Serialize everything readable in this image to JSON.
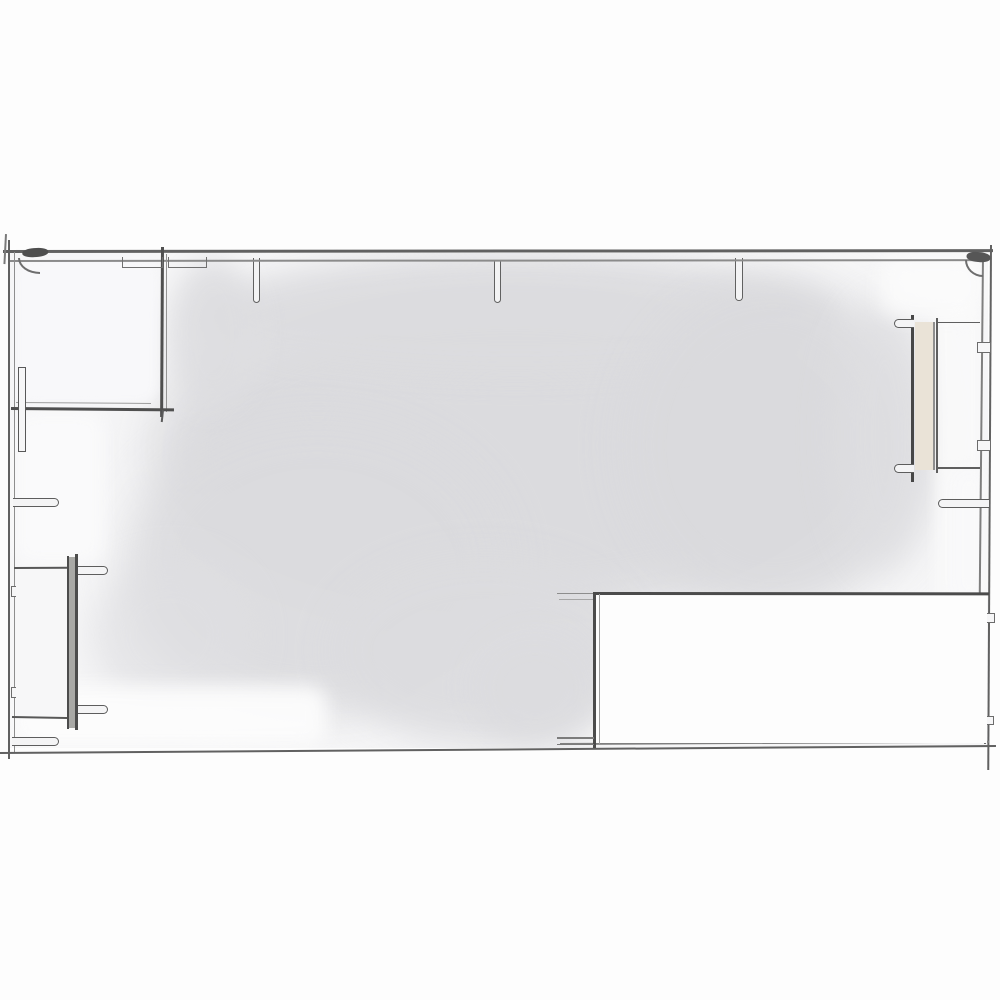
{
  "meta": {
    "description": "hand-drawn architectural floor plan sketch, pencil lines with light gray watercolor wash",
    "canvas_width": 1000,
    "canvas_height": 1000
  },
  "colors": {
    "paper": "#fdfdfd",
    "wash": "#dadadd",
    "line_dark": "#4b4b4b",
    "line_mid": "#616161",
    "line_light": "#8e8e8e",
    "panel_beige": "#eae3d7",
    "bar_gray": "#a9a9a6"
  },
  "plan": {
    "clip": {
      "x": 10,
      "y": 253,
      "w": 978,
      "h": 495
    },
    "wash": [
      {
        "name": "wash-blob-main",
        "type": "blob",
        "x": 150,
        "y": 278,
        "w": 720,
        "h": 345,
        "c": "#dadadd",
        "blur": 26,
        "op": 0.95
      },
      {
        "name": "wash-blob-top-band",
        "type": "blob",
        "x": 195,
        "y": 256,
        "w": 640,
        "h": 120,
        "c": "#dcdcdf",
        "blur": 15,
        "op": 0.9
      },
      {
        "name": "wash-blob-right",
        "type": "blob",
        "x": 620,
        "y": 278,
        "w": 305,
        "h": 335,
        "c": "#dadadd",
        "blur": 22,
        "op": 0.9
      },
      {
        "name": "wash-blob-left-lower",
        "type": "blob",
        "x": 125,
        "y": 415,
        "w": 385,
        "h": 300,
        "c": "#dbdbde",
        "blur": 22,
        "op": 0.9
      },
      {
        "name": "wash-blob-bottom",
        "type": "blob",
        "x": 330,
        "y": 555,
        "w": 310,
        "h": 190,
        "c": "#dcdcdf",
        "blur": 18,
        "op": 0.92
      },
      {
        "name": "wash-blob-right-edge",
        "type": "blob",
        "x": 835,
        "y": 300,
        "w": 100,
        "h": 270,
        "c": "#dedee1",
        "blur": 18,
        "op": 0.75
      },
      {
        "name": "wash-blob-room-edge",
        "type": "blob",
        "x": 168,
        "y": 258,
        "w": 90,
        "h": 150,
        "c": "#dddde0",
        "blur": 13,
        "op": 0.85
      },
      {
        "name": "wash-blob-bottom-left",
        "type": "blob",
        "x": 90,
        "y": 560,
        "w": 160,
        "h": 150,
        "c": "#dfdfe2",
        "blur": 18,
        "op": 0.7
      },
      {
        "name": "wash-blob-bottom-strip",
        "type": "blob",
        "x": 470,
        "y": 630,
        "w": 130,
        "h": 115,
        "c": "#dcdcdf",
        "blur": 15,
        "op": 0.9
      },
      {
        "name": "white-room1-interior",
        "type": "cover",
        "x": 17,
        "y": 258,
        "w": 141,
        "h": 146,
        "c": "rgba(248,248,250,0.95)",
        "blur": 5
      },
      {
        "name": "white-left-strip",
        "type": "cover",
        "x": 14,
        "y": 412,
        "w": 90,
        "h": 152,
        "c": "rgba(250,250,251,0.95)",
        "blur": 8
      },
      {
        "name": "white-bottom-left",
        "type": "cover",
        "x": 12,
        "y": 686,
        "w": 315,
        "h": 60,
        "c": "rgba(252,252,252,0.95)",
        "blur": 9
      },
      {
        "name": "white-right-strip",
        "type": "cover",
        "x": 936,
        "y": 305,
        "w": 46,
        "h": 305,
        "c": "rgba(249,249,250,0.9)",
        "blur": 6
      },
      {
        "name": "white-top-right",
        "type": "cover",
        "x": 880,
        "y": 255,
        "w": 105,
        "h": 62,
        "c": "rgba(251,251,252,0.85)",
        "blur": 10
      },
      {
        "name": "white-right-margin-low",
        "type": "cover",
        "x": 952,
        "y": 468,
        "w": 34,
        "h": 135,
        "c": "rgba(249,249,250,0.8)",
        "blur": 8
      }
    ],
    "elements": [
      {
        "name": "column-stub-top-1",
        "type": "stub",
        "x": 252.5,
        "y": 258,
        "w": 7.5,
        "h": 45,
        "t": 1.8,
        "c": "#616161",
        "open": "top",
        "fill": "#f3f3f4"
      },
      {
        "name": "column-stub-top-2",
        "type": "stub",
        "x": 493.5,
        "y": 260,
        "w": 7.5,
        "h": 43,
        "t": 1.8,
        "c": "#616161",
        "open": "top",
        "fill": "#f3f3f4"
      },
      {
        "name": "column-stub-top-3",
        "type": "stub",
        "x": 735,
        "y": 258,
        "w": 7.5,
        "h": 43,
        "t": 1.8,
        "c": "#616161",
        "open": "top",
        "fill": "#f3f3f4"
      },
      {
        "name": "wall-top-outer",
        "type": "hline",
        "x": 3,
        "y": 250,
        "w": 990,
        "h": 2.6,
        "c": "#616161",
        "rot": -0.05
      },
      {
        "name": "wall-top-inner",
        "type": "hline",
        "x": 8,
        "y": 259.5,
        "w": 975,
        "h": 1.8,
        "c": "#8b8b8b",
        "rot": -0.05
      },
      {
        "name": "wall-left-outer",
        "type": "vline",
        "x": 7.5,
        "y": 240,
        "w": 2.3,
        "h": 519,
        "c": "#616161"
      },
      {
        "name": "wall-left-inner",
        "type": "vline",
        "x": 13.5,
        "y": 252,
        "w": 1.7,
        "h": 500,
        "c": "#8e8e8e"
      },
      {
        "name": "wall-left-overshoot",
        "type": "vline",
        "x": 4.5,
        "y": 234,
        "w": 1.6,
        "h": 30,
        "c": "#7a7a7a",
        "rot": 3
      },
      {
        "name": "wall-right-outer",
        "type": "vline",
        "x": 989.5,
        "y": 245,
        "w": 2.4,
        "h": 525,
        "c": "#616161",
        "rot": 0.3
      },
      {
        "name": "wall-right-inner",
        "type": "vline",
        "x": 982,
        "y": 256,
        "w": 1.8,
        "h": 352,
        "c": "#7f7f7f",
        "rot": 0.55
      },
      {
        "name": "wall-bottom-outer",
        "type": "hline",
        "x": 0,
        "y": 752,
        "w": 996,
        "h": 2.3,
        "c": "#616161",
        "rot": -0.4
      },
      {
        "name": "wall-bottom-inner",
        "type": "hline",
        "x": 560,
        "y": 743,
        "w": 429,
        "h": 1.7,
        "c": "#7f7f7f",
        "rot": -0.3
      },
      {
        "name": "corner-knot-tl",
        "type": "fill",
        "x": 22,
        "y": 249,
        "w": 26,
        "h": 9,
        "c": "#4e4e4e",
        "rot": -4,
        "rad": "45%"
      },
      {
        "name": "corner-arc-tl",
        "type": "arc",
        "x": 18,
        "y": 258,
        "w": 22,
        "h": 16,
        "t": 2,
        "c": "#6e6e6e",
        "corner": "bl"
      },
      {
        "name": "corner-knot-tr",
        "type": "fill",
        "x": 967,
        "y": 251,
        "w": 24,
        "h": 10,
        "c": "#565656",
        "rot": 5,
        "rad": "45%"
      },
      {
        "name": "corner-arc-tr",
        "type": "arc",
        "x": 965,
        "y": 260,
        "w": 18,
        "h": 17,
        "t": 2,
        "c": "#6e6e6e",
        "corner": "bl"
      },
      {
        "name": "room1-wall-vertical",
        "type": "vline",
        "x": 160.5,
        "y": 247,
        "w": 2.9,
        "h": 170,
        "c": "#4f4f4f",
        "rot": 0.3
      },
      {
        "name": "room1-wall-vertical-double",
        "type": "vline",
        "x": 166,
        "y": 254,
        "w": 1.4,
        "h": 158,
        "c": "#949494"
      },
      {
        "name": "room1-wall-horizontal",
        "type": "hline",
        "x": 11,
        "y": 406.5,
        "w": 163,
        "h": 2.9,
        "c": "#4f4f4f",
        "rot": 0.5
      },
      {
        "name": "room1-wall-horizontal-double",
        "type": "hline",
        "x": 16,
        "y": 402,
        "w": 135,
        "h": 1.3,
        "c": "#9e9e9e",
        "rot": 0.4
      },
      {
        "name": "room1-wall-overshoot",
        "type": "vline",
        "x": 162,
        "y": 410,
        "w": 2.2,
        "h": 12,
        "c": "#5a5a5a",
        "rot": 6
      },
      {
        "name": "opening-bracket-left",
        "type": "bracket",
        "x": 122,
        "y": 256.5,
        "w": 41,
        "h": 11,
        "t": 1.8,
        "c": "#707070"
      },
      {
        "name": "opening-bracket-right",
        "type": "bracket",
        "x": 167.5,
        "y": 256.5,
        "w": 39,
        "h": 11,
        "t": 1.8,
        "c": "#707070"
      },
      {
        "name": "door-leaf-left",
        "type": "rect",
        "x": 17.5,
        "y": 367,
        "w": 8,
        "h": 85,
        "t": 1.9,
        "c": "#585858",
        "fill": "#f6f6f7"
      },
      {
        "name": "door-stub-left-1",
        "type": "stub",
        "x": 13,
        "y": 497.5,
        "w": 46,
        "h": 9.5,
        "t": 1.8,
        "c": "#5d5d5d",
        "open": "left",
        "fill": "#f4f4f5"
      },
      {
        "name": "wall-tab-left-1",
        "type": "rect",
        "x": 10.5,
        "y": 586,
        "w": 10.5,
        "h": 11,
        "t": 1.5,
        "c": "#6c6c6c",
        "fill": "#f6f6f7"
      },
      {
        "name": "wall-tab-left-2",
        "type": "rect",
        "x": 10.5,
        "y": 687,
        "w": 10.5,
        "h": 11,
        "t": 1.5,
        "c": "#6c6c6c",
        "fill": "#f6f6f7"
      },
      {
        "name": "door-stub-left-2",
        "type": "stub",
        "x": 12,
        "y": 736.5,
        "w": 47,
        "h": 9,
        "t": 1.8,
        "c": "#5d5d5d",
        "open": "left",
        "fill": "#f4f4f5"
      },
      {
        "name": "room2-fill",
        "type": "fill",
        "x": 16,
        "y": 569,
        "w": 51,
        "h": 147,
        "c": "#f7f7f8"
      },
      {
        "name": "room2-wall-top",
        "type": "hline",
        "x": 14,
        "y": 567,
        "w": 54,
        "h": 2.1,
        "c": "#575757",
        "rot": -0.3
      },
      {
        "name": "room2-wall-bottom",
        "type": "hline",
        "x": 12,
        "y": 716,
        "w": 62,
        "h": 2.3,
        "c": "#575757",
        "rot": 1
      },
      {
        "name": "room2-bar-fill",
        "type": "fill",
        "x": 69,
        "y": 557,
        "w": 6.5,
        "h": 171,
        "c": "#a9a9a6"
      },
      {
        "name": "room2-bar-left-line",
        "type": "vline",
        "x": 66.8,
        "y": 556,
        "w": 2.3,
        "h": 173,
        "c": "#4c4c4c"
      },
      {
        "name": "room2-bar-right-line",
        "type": "vline",
        "x": 75.3,
        "y": 554,
        "w": 2.3,
        "h": 176,
        "c": "#4c4c4c"
      },
      {
        "name": "door-stub-bl-1",
        "type": "stub",
        "x": 78,
        "y": 566,
        "w": 30,
        "h": 9,
        "t": 1.7,
        "c": "#5d5d5d",
        "open": "left",
        "fill": "#f4f4f5"
      },
      {
        "name": "door-stub-bl-2",
        "type": "stub",
        "x": 78,
        "y": 704.5,
        "w": 30,
        "h": 9,
        "t": 1.7,
        "c": "#5d5d5d",
        "open": "left",
        "fill": "#f4f4f5"
      },
      {
        "name": "door2-jamb-line",
        "type": "vline",
        "x": 910.5,
        "y": 315,
        "w": 3,
        "h": 167,
        "c": "#474747"
      },
      {
        "name": "door2-panel",
        "type": "fill",
        "x": 914.5,
        "y": 322,
        "w": 18.5,
        "h": 148,
        "c": "#eae3d7"
      },
      {
        "name": "door2-panel-edge",
        "type": "vline",
        "x": 933,
        "y": 322,
        "w": 1.7,
        "h": 148,
        "c": "#8f8f8f"
      },
      {
        "name": "door2-inner-line",
        "type": "vline",
        "x": 936.2,
        "y": 318,
        "w": 1.9,
        "h": 155,
        "c": "#5f5f5f"
      },
      {
        "name": "door2-top-line",
        "type": "hline",
        "x": 937,
        "y": 321.5,
        "w": 43,
        "h": 1.9,
        "c": "#5f5f5f"
      },
      {
        "name": "door2-bottom-line",
        "type": "hline",
        "x": 937,
        "y": 467,
        "w": 43,
        "h": 1.9,
        "c": "#5f5f5f"
      },
      {
        "name": "door-stub-right-top",
        "type": "stub",
        "x": 894,
        "y": 319,
        "w": 20,
        "h": 9,
        "t": 1.7,
        "c": "#5d5d5d",
        "open": "right",
        "fill": "#f4f4f5"
      },
      {
        "name": "door-stub-right-bottom",
        "type": "stub",
        "x": 894,
        "y": 464,
        "w": 20,
        "h": 9,
        "t": 1.7,
        "c": "#5d5d5d",
        "open": "right",
        "fill": "#f4f4f5"
      },
      {
        "name": "wall-tab-right-1",
        "type": "rect",
        "x": 976.5,
        "y": 342,
        "w": 14,
        "h": 10.5,
        "t": 1.5,
        "c": "#6c6c6c",
        "fill": "#f6f6f7"
      },
      {
        "name": "wall-tab-right-2",
        "type": "rect",
        "x": 976.5,
        "y": 440,
        "w": 14,
        "h": 10.5,
        "t": 1.5,
        "c": "#6c6c6c",
        "fill": "#f6f6f7"
      },
      {
        "name": "door-stub-right-mid",
        "type": "stub",
        "x": 938,
        "y": 498.5,
        "w": 51,
        "h": 9.5,
        "t": 1.8,
        "c": "#5d5d5d",
        "open": "right",
        "fill": "#f4f4f5"
      },
      {
        "name": "wall-tab-right-3",
        "type": "rect",
        "x": 982.5,
        "y": 613,
        "w": 12,
        "h": 10,
        "t": 1.5,
        "c": "#6c6c6c",
        "fill": "#f6f6f7"
      },
      {
        "name": "wall-tab-right-4",
        "type": "rect",
        "x": 982.5,
        "y": 715.5,
        "w": 11,
        "h": 9,
        "t": 1.5,
        "c": "#6c6c6c",
        "fill": "#f6f6f7"
      },
      {
        "name": "wall-tick-right-bottom",
        "type": "vline",
        "x": 984,
        "y": 729,
        "w": 2,
        "h": 15,
        "c": "#6c6c6c"
      },
      {
        "name": "area-br-fill",
        "type": "fill",
        "x": 596,
        "y": 594,
        "w": 391,
        "h": 149,
        "c": "#fdfdfd"
      },
      {
        "name": "area-br-top-edge",
        "type": "hline",
        "x": 593,
        "y": 591.5,
        "w": 396,
        "h": 2.7,
        "c": "#4b4b4b",
        "rot": 0.05
      },
      {
        "name": "area-br-left-edge",
        "type": "vline",
        "x": 593.2,
        "y": 592,
        "w": 2.5,
        "h": 156,
        "c": "#4b4b4b"
      },
      {
        "name": "area-br-left-edge-double",
        "type": "vline",
        "x": 599,
        "y": 594,
        "w": 1.2,
        "h": 150,
        "c": "#9d9d9d"
      },
      {
        "name": "threshold-tick-top-a",
        "type": "hline",
        "x": 557,
        "y": 592.5,
        "w": 36,
        "h": 1.5,
        "c": "#8d8d8d"
      },
      {
        "name": "threshold-tick-top-b",
        "type": "hline",
        "x": 559,
        "y": 598.5,
        "w": 34,
        "h": 1.2,
        "c": "#a6a6a6"
      },
      {
        "name": "threshold-tick-bottom-a",
        "type": "hline",
        "x": 557,
        "y": 737,
        "w": 37,
        "h": 1.7,
        "c": "#7c7c7c"
      },
      {
        "name": "threshold-tick-bottom-b",
        "type": "hline",
        "x": 557,
        "y": 743.5,
        "w": 37,
        "h": 1.7,
        "c": "#7c7c7c"
      }
    ]
  }
}
